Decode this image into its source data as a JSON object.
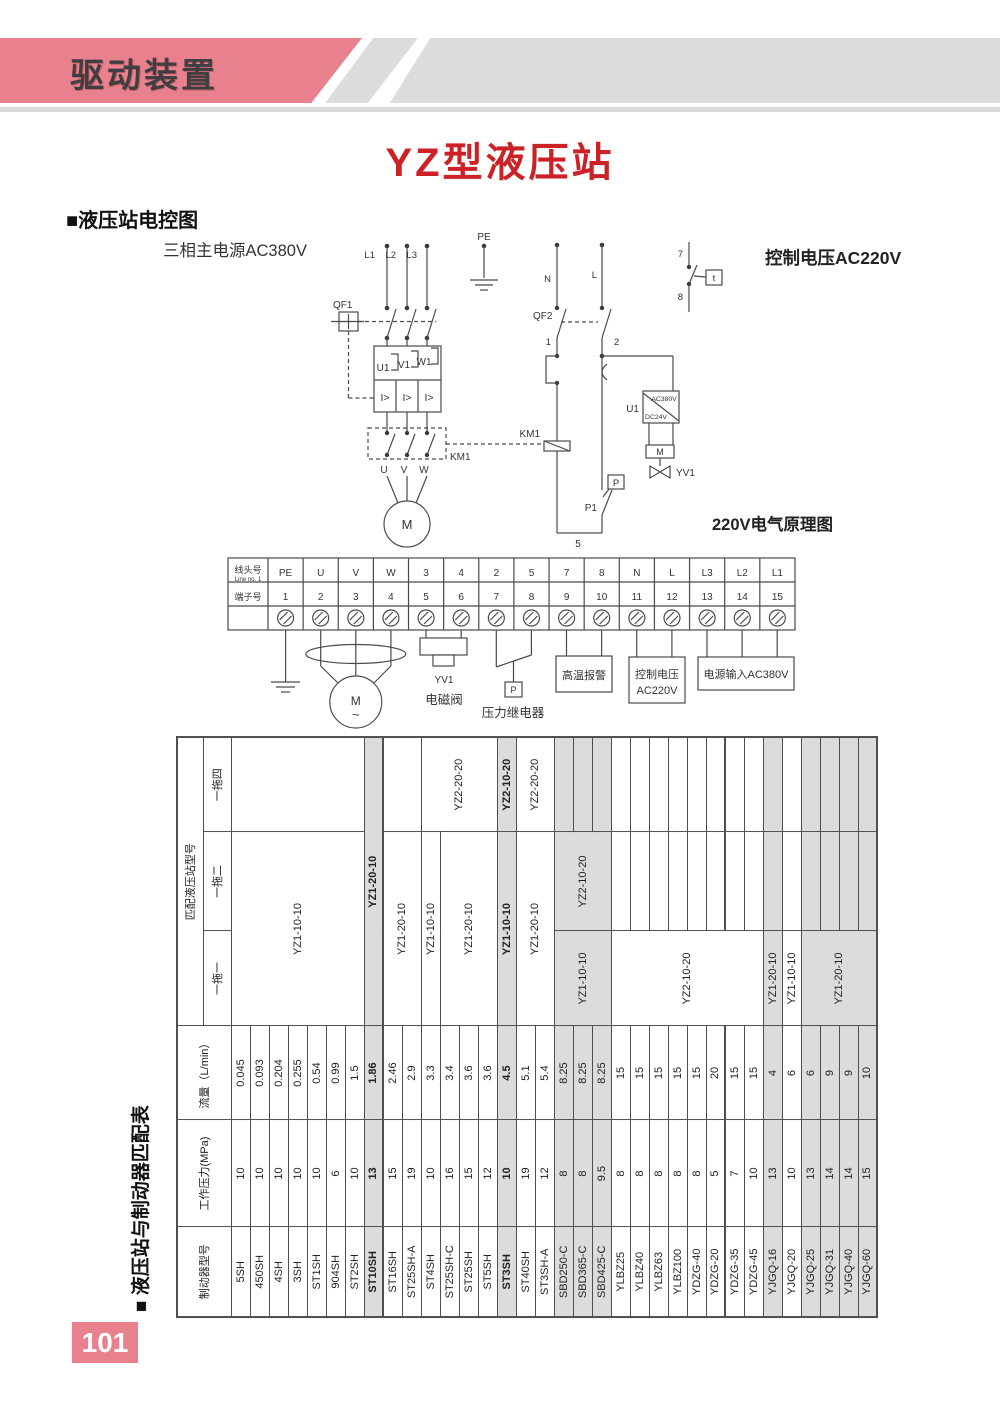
{
  "colors": {
    "pink": "#e8808d",
    "title_red": "#cc2127",
    "band_gray": "#dcdcdc",
    "shade": "#dcdcdc",
    "ink": "#3c3c3e",
    "line": "#4a4a4a"
  },
  "header": {
    "band_title": "驱动装置"
  },
  "title": "YZ型液压站",
  "sections": {
    "control_diagram": "■液压站电控图",
    "match_table_caption": "■ 液压站与制动器匹配表"
  },
  "page_number": "101",
  "circuit": {
    "main_power": "三相主电源AC380V",
    "control_voltage": "控制电压AC220V",
    "schematic": "220V电气原理图",
    "pe": "PE",
    "l1": "L1",
    "l2": "L2",
    "l3": "L3",
    "qf1": "QF1",
    "u1": "U1",
    "v1": "V1",
    "w1": "W1",
    "oc1": "I>",
    "oc2": "I>",
    "oc3": "I>",
    "km1": "KM1",
    "u": "U",
    "v": "V",
    "w": "W",
    "motor": "M",
    "n": "N",
    "l": "L",
    "qf2": "QF2",
    "c1": "1",
    "c2": "2",
    "c5": "5",
    "c7": "7",
    "c8": "8",
    "t": "t",
    "km1_coil": "KM1",
    "u1r": "U1",
    "ac380": "AC380V",
    "dc24": "DC24V",
    "mv": "M",
    "yv1": "YV1",
    "p": "P",
    "p1": "P1"
  },
  "terminal_strip": {
    "row1": "线头号",
    "row1_sub": "Line no. 1",
    "row2": "端子号",
    "lines": [
      "PE",
      "U",
      "V",
      "W",
      "3",
      "4",
      "2",
      "5",
      "7",
      "8",
      "N",
      "L",
      "L3",
      "L2",
      "L1"
    ],
    "numbers": [
      "1",
      "2",
      "3",
      "4",
      "5",
      "6",
      "7",
      "8",
      "9",
      "10",
      "11",
      "12",
      "13",
      "14",
      "15"
    ]
  },
  "bottom": {
    "motor": "M",
    "wave": "~",
    "yv1": "YV1",
    "solenoid": "电磁阀",
    "p": "P",
    "pressure_relay": "压力继电器",
    "alarm": "高温报警",
    "ctrl1": "控制电压",
    "ctrl2": "AC220V",
    "power": "电源输入AC380V"
  },
  "match_table": {
    "headers": {
      "model": "制动器型号",
      "pressure": "工作压力(MPa)",
      "flow": "流量（L/min）",
      "match": "匹配液压站型号",
      "one": "一拖一",
      "two": "一拖二",
      "four": "一拖四"
    },
    "rows": [
      {
        "model": "5SH",
        "pressure": "10",
        "flow": "0.045"
      },
      {
        "model": "450SH",
        "pressure": "10",
        "flow": "0.093"
      },
      {
        "model": "4SH",
        "pressure": "10",
        "flow": "0.204"
      },
      {
        "model": "3SH",
        "pressure": "10",
        "flow": "0.255"
      },
      {
        "model": "ST1SH",
        "pressure": "10",
        "flow": "0.54"
      },
      {
        "model": "904SH",
        "pressure": "6",
        "flow": "0.99"
      },
      {
        "model": "ST2SH",
        "pressure": "10",
        "flow": "1.5"
      },
      {
        "model": "ST10SH",
        "pressure": "13",
        "flow": "1.86",
        "shaded": true,
        "bold": true,
        "thick": true
      },
      {
        "model": "ST16SH",
        "pressure": "15",
        "flow": "2.46"
      },
      {
        "model": "ST25SH-A",
        "pressure": "19",
        "flow": "2.9"
      },
      {
        "model": "ST4SH",
        "pressure": "10",
        "flow": "3.3"
      },
      {
        "model": "ST25SH-C",
        "pressure": "16",
        "flow": "3.4"
      },
      {
        "model": "ST25SH",
        "pressure": "15",
        "flow": "3.6"
      },
      {
        "model": "ST5SH",
        "pressure": "12",
        "flow": "3.6"
      },
      {
        "model": "ST3SH",
        "pressure": "10",
        "flow": "4.5",
        "shaded": true,
        "bold": true
      },
      {
        "model": "ST40SH",
        "pressure": "19",
        "flow": "5.1"
      },
      {
        "model": "ST3SH-A",
        "pressure": "12",
        "flow": "5.4"
      },
      {
        "model": "SBD250-C",
        "pressure": "8",
        "flow": "8.25",
        "shaded": true
      },
      {
        "model": "SBD365-C",
        "pressure": "8",
        "flow": "8.25",
        "shaded": true
      },
      {
        "model": "SBD425-C",
        "pressure": "9.5",
        "flow": "8.25",
        "shaded": true
      },
      {
        "model": "YLBZ25",
        "pressure": "8",
        "flow": "15"
      },
      {
        "model": "YLBZ40",
        "pressure": "8",
        "flow": "15"
      },
      {
        "model": "YLBZ63",
        "pressure": "8",
        "flow": "15"
      },
      {
        "model": "YLBZ100",
        "pressure": "8",
        "flow": "15"
      },
      {
        "model": "YDZG-40",
        "pressure": "8",
        "flow": "15"
      },
      {
        "model": "YDZG-20",
        "pressure": "5",
        "flow": "20",
        "thick": true
      },
      {
        "model": "YDZG-35",
        "pressure": "7",
        "flow": "15"
      },
      {
        "model": "YDZG-45",
        "pressure": "10",
        "flow": "15"
      },
      {
        "model": "YJGQ-16",
        "pressure": "13",
        "flow": "4",
        "shaded": true
      },
      {
        "model": "YJGQ-20",
        "pressure": "10",
        "flow": "6"
      },
      {
        "model": "YJGQ-25",
        "pressure": "13",
        "flow": "6",
        "shaded": true
      },
      {
        "model": "YJGQ-31",
        "pressure": "14",
        "flow": "9",
        "shaded": true
      },
      {
        "model": "YJGQ-40",
        "pressure": "14",
        "flow": "9",
        "shaded": true
      },
      {
        "model": "YJGQ-60",
        "pressure": "15",
        "flow": "10",
        "shaded": true
      }
    ],
    "cells": [
      {
        "r": 1,
        "c": 1,
        "cs": 2,
        "rs": 7,
        "t": "YZ1-10-10"
      },
      {
        "r": 1,
        "c": 3,
        "cs": 1,
        "rs": 7,
        "t": ""
      },
      {
        "r": 8,
        "c": 1,
        "cs": 3,
        "rs": 1,
        "t": "YZ1-20-10",
        "bold": true,
        "shaded": true
      },
      {
        "r": 9,
        "c": 1,
        "cs": 2,
        "rs": 2,
        "t": "YZ1-20-10"
      },
      {
        "r": 9,
        "c": 3,
        "cs": 1,
        "rs": 2,
        "t": ""
      },
      {
        "r": 11,
        "c": 1,
        "cs": 2,
        "rs": 1,
        "t": "YZ1-10-10"
      },
      {
        "r": 11,
        "c": 3,
        "cs": 1,
        "rs": 4,
        "t": "YZ2-20-20"
      },
      {
        "r": 12,
        "c": 1,
        "cs": 2,
        "rs": 3,
        "t": "YZ1-20-10"
      },
      {
        "r": 15,
        "c": 1,
        "cs": 2,
        "rs": 1,
        "t": "YZ1-10-10",
        "bold": true,
        "shaded": true
      },
      {
        "r": 15,
        "c": 3,
        "cs": 1,
        "rs": 1,
        "t": "YZ2-10-20",
        "bold": true,
        "shaded": true
      },
      {
        "r": 16,
        "c": 1,
        "cs": 2,
        "rs": 2,
        "t": "YZ1-20-10"
      },
      {
        "r": 16,
        "c": 3,
        "cs": 1,
        "rs": 2,
        "t": "YZ2-20-20"
      },
      {
        "r": 18,
        "c": 1,
        "cs": 1,
        "rs": 3,
        "t": "YZ1-10-10",
        "shaded": true
      },
      {
        "r": 18,
        "c": 2,
        "cs": 1,
        "rs": 3,
        "t": "YZ2-10-20",
        "shaded": true
      },
      {
        "r": 21,
        "c": 1,
        "cs": 1,
        "rs": 8,
        "t": "YZ2-10-20"
      },
      {
        "r": 29,
        "c": 1,
        "cs": 1,
        "rs": 1,
        "t": "YZ1-20-10",
        "shaded": true
      },
      {
        "r": 30,
        "c": 1,
        "cs": 1,
        "rs": 1,
        "t": "YZ1-10-10"
      },
      {
        "r": 31,
        "c": 1,
        "cs": 1,
        "rs": 4,
        "t": "YZ1-20-10",
        "shaded": true
      }
    ]
  }
}
